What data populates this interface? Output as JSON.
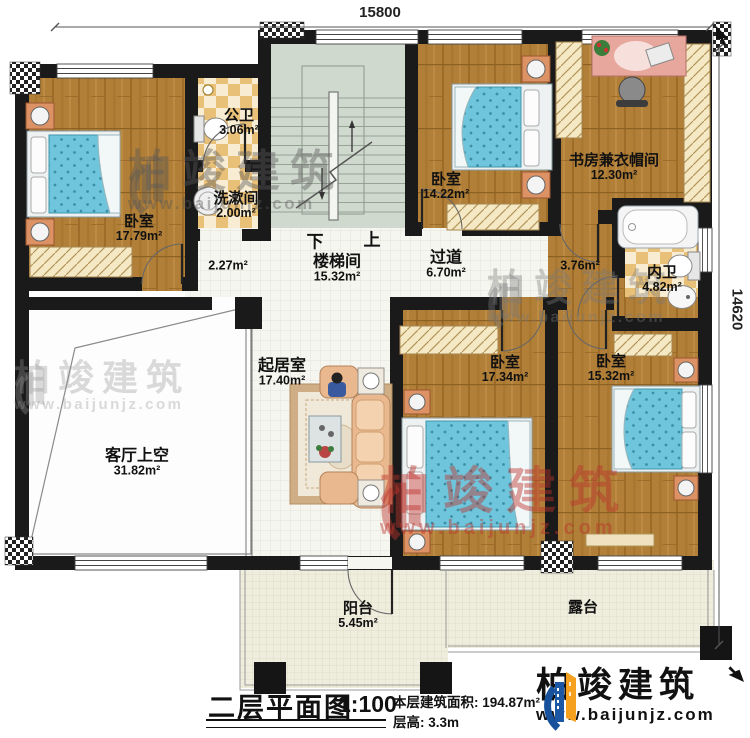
{
  "dimensions": {
    "top": "15800",
    "right": "14620"
  },
  "rooms": {
    "bedroom_nw": {
      "name": "卧室",
      "area": "17.79m²"
    },
    "public_bath": {
      "name": "公卫",
      "area": "3.06m²"
    },
    "washroom": {
      "name": "洗漱间",
      "area": "2.00m²"
    },
    "stairwell": {
      "name": "楼梯间",
      "area": "15.32m²"
    },
    "hall_area": {
      "area": "2.27m²"
    },
    "corridor": {
      "name": "过道",
      "area": "6.70m²"
    },
    "bedroom_ne": {
      "name": "卧室",
      "area": "14.22m²"
    },
    "study_cloakroom": {
      "name": "书房兼衣帽间",
      "area": "12.30m²"
    },
    "inner_bath": {
      "name": "内卫",
      "area": "4.82m²"
    },
    "corridor_area": {
      "area": "3.76m²"
    },
    "living_room": {
      "name": "起居室",
      "area": "17.40m²"
    },
    "void_above_living": {
      "name": "客厅上空",
      "area": "31.82m²"
    },
    "bedroom_s": {
      "name": "卧室",
      "area": "17.34m²"
    },
    "bedroom_se": {
      "name": "卧室",
      "area": "15.32m²"
    },
    "balcony": {
      "name": "阳台",
      "area": "5.45m²"
    },
    "terrace": {
      "name": "露台"
    }
  },
  "stairs": {
    "down": "下",
    "up": "上"
  },
  "caption": {
    "title": "二层平面图",
    "scale": "1:100",
    "floor_area": "本层建筑面积: 194.87m²",
    "floor_height": "层高: 3.3m"
  },
  "brand": {
    "name": "柏竣建筑",
    "url": "www.baijunjz.com"
  },
  "watermark": {
    "name": "柏竣建筑",
    "url": "www.baijunjz.com"
  },
  "colors": {
    "wall": "#1a1a1a",
    "wood": "#b17f38",
    "tile_white": "#f6f6f0",
    "tile_bath": "#e9c078",
    "stair": "#cfd9cd",
    "balcony": "#efeede",
    "mattress": "#6fc5db",
    "brand_blue": "#1b57a5",
    "brand_orange": "#f5a01e",
    "watermark_red": "#bc342c"
  }
}
